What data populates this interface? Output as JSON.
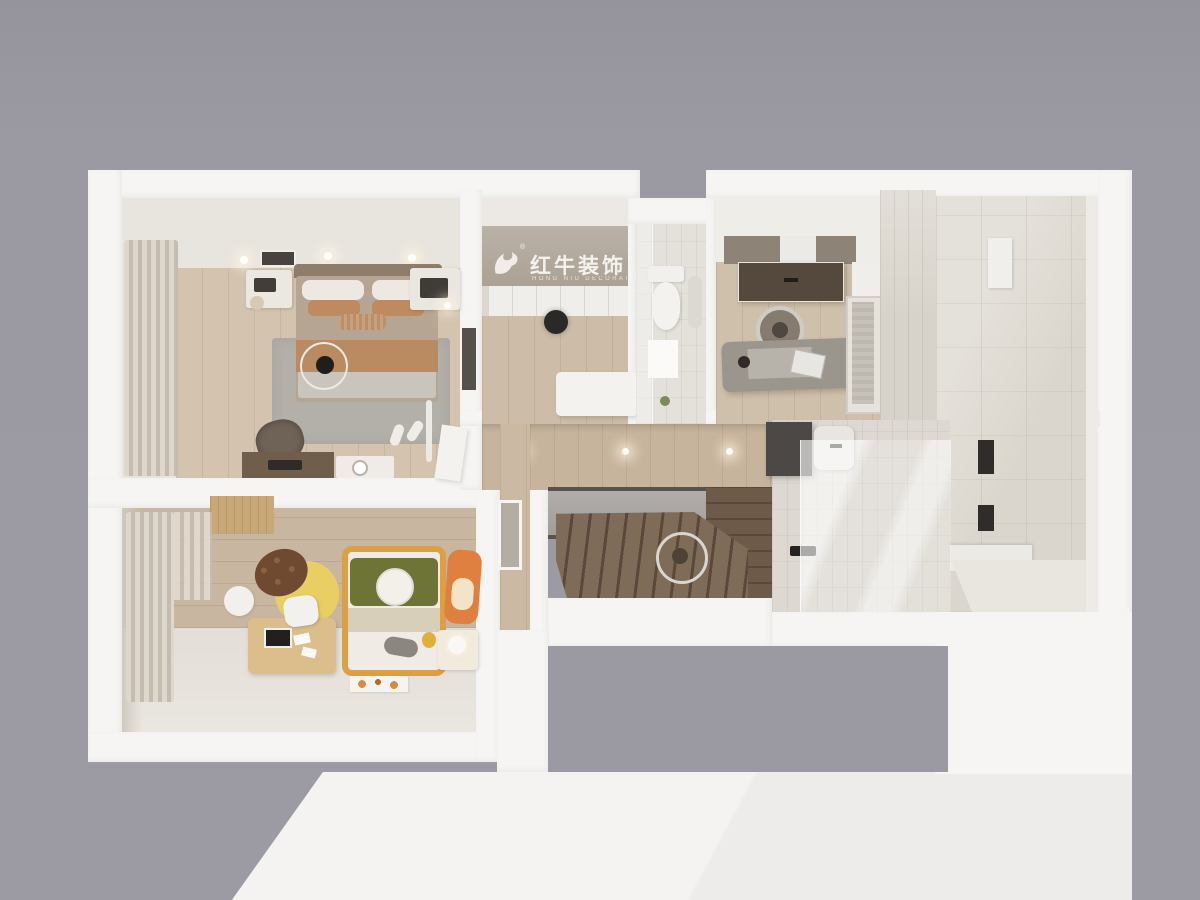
{
  "scene": {
    "type": "3d-floorplan-top-view-render",
    "description": "Bird's-eye dollhouse render of an apartment: master bedroom, closet hall, WC, study, shower room, glass bathroom, staircase, kids bedroom"
  },
  "watermark": {
    "icon": "bull-icon",
    "registered": "®",
    "title": "红牛装饰",
    "subtitle": "HONG NIU DECORATION"
  },
  "palette": {
    "background": "#9b9aa2",
    "wall_white": "#f6f5f3",
    "wall_beige": "#e8e4de",
    "logo_wall": "#b4aca1",
    "wood_floor": "#d3c3af",
    "wood_hallway": "#c7b49d",
    "wood_kids": "#c9b6a0",
    "stair_wood": "#6f5c4b",
    "landing_gray": "#a8a5a1",
    "tile_small": "#e4e1db",
    "tile_large": "#dbd6cd",
    "cabinet_taupe": "#8e8377",
    "counter_dark": "#55483c",
    "bed_duvet": "#b6a593",
    "bed_runner": "#ba8a61",
    "rug_gray": "#b3afa9",
    "kids_bed_frame": "#dd9f46",
    "kids_blanket_green": "#6e7336",
    "acorn_yellow": "#e9cf63",
    "acorn_cap": "#6f4a31",
    "fox_orange": "#e08040"
  }
}
